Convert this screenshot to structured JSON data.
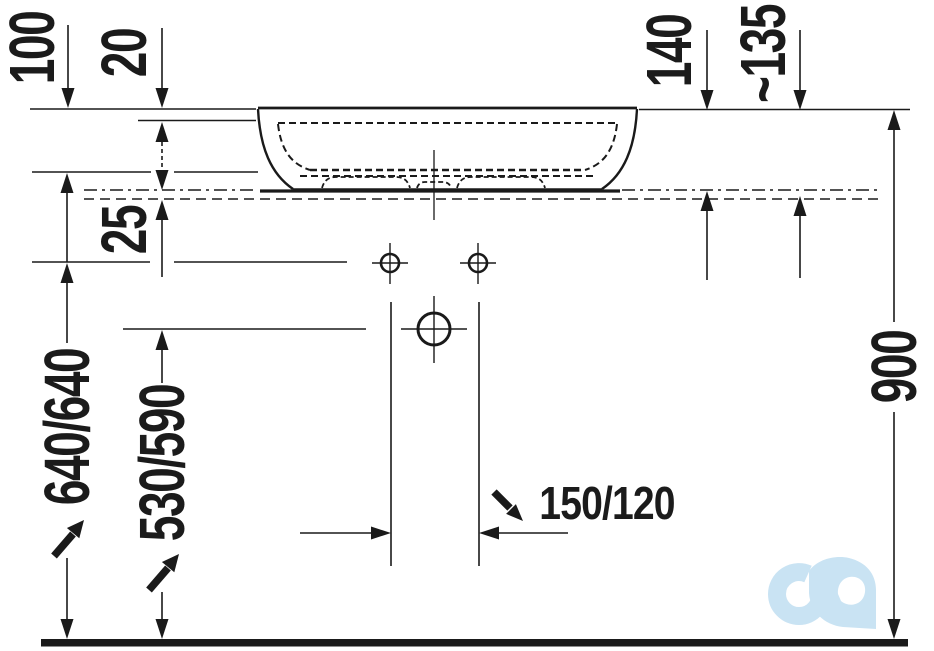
{
  "drawing": {
    "dim_labels": {
      "basin_depth": "100",
      "rim_offset": "20",
      "rim_to_counter": "140",
      "rim_to_counter_approx": "~135",
      "counter_thickness": "25",
      "faucet_hole_height": "640/640",
      "drain_height": "530/590",
      "rim_height": "900",
      "hole_spacing": "150/120"
    },
    "logo": {
      "label": "cd",
      "color": "#c9e3f3"
    },
    "colors": {
      "line": "#1a1a1a",
      "background": "#ffffff"
    }
  }
}
